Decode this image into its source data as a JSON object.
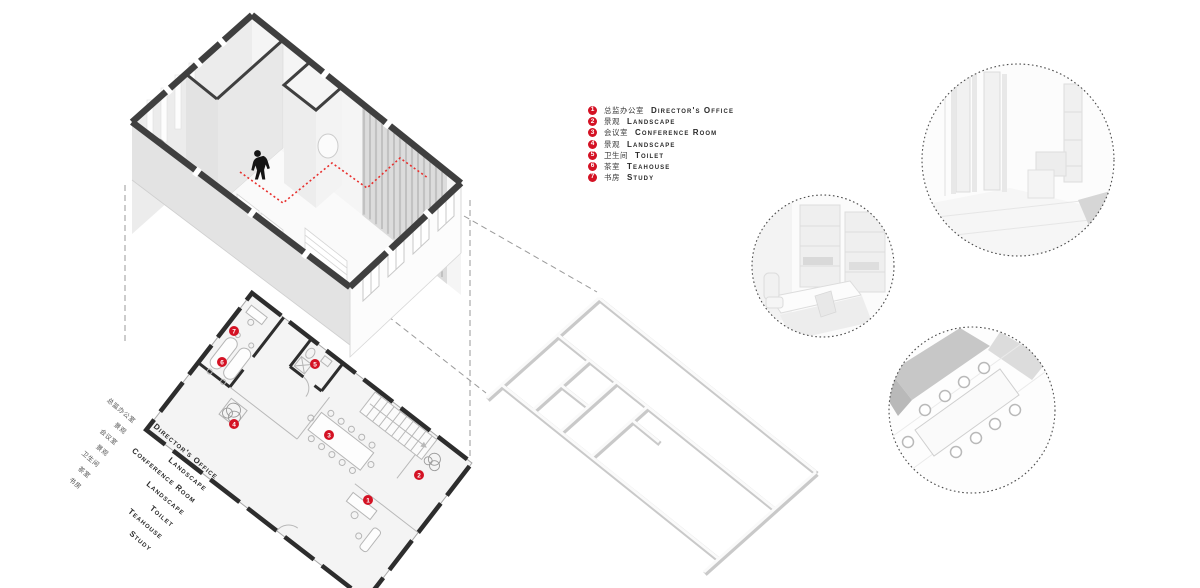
{
  "board": {
    "description": "Office interior exploded axonometric presentation board"
  },
  "colors": {
    "accent_red": "#d41224",
    "cut_wall_dark": "#3f3f3f",
    "plan_wall_dark": "#2d2d2d",
    "light_gray": "#e8e8e8",
    "background": "#ffffff"
  },
  "legend": {
    "items": [
      {
        "num": "1",
        "zh": "总监办公室",
        "en": "Director's Office"
      },
      {
        "num": "2",
        "zh": "景观",
        "en": "Landscape"
      },
      {
        "num": "3",
        "zh": "会议室",
        "en": "Conference Room"
      },
      {
        "num": "4",
        "zh": "景观",
        "en": "Landscape"
      },
      {
        "num": "5",
        "zh": "卫生间",
        "en": "Toilet"
      },
      {
        "num": "6",
        "zh": "茶室",
        "en": "Teahouse"
      },
      {
        "num": "7",
        "zh": "书房",
        "en": "Study"
      }
    ]
  },
  "side_labels": {
    "zh": [
      "总监办公室",
      "景观",
      "会议室",
      "景观",
      "卫生间",
      "茶室",
      "书房"
    ],
    "en": [
      "Director's Office",
      "Landscape",
      "Conference Room",
      "Landscape",
      "Toilet",
      "Teahouse",
      "Study"
    ]
  },
  "markers": [
    {
      "n": "1"
    },
    {
      "n": "2"
    },
    {
      "n": "3"
    },
    {
      "n": "4"
    },
    {
      "n": "5"
    },
    {
      "n": "6"
    },
    {
      "n": "7"
    }
  ]
}
